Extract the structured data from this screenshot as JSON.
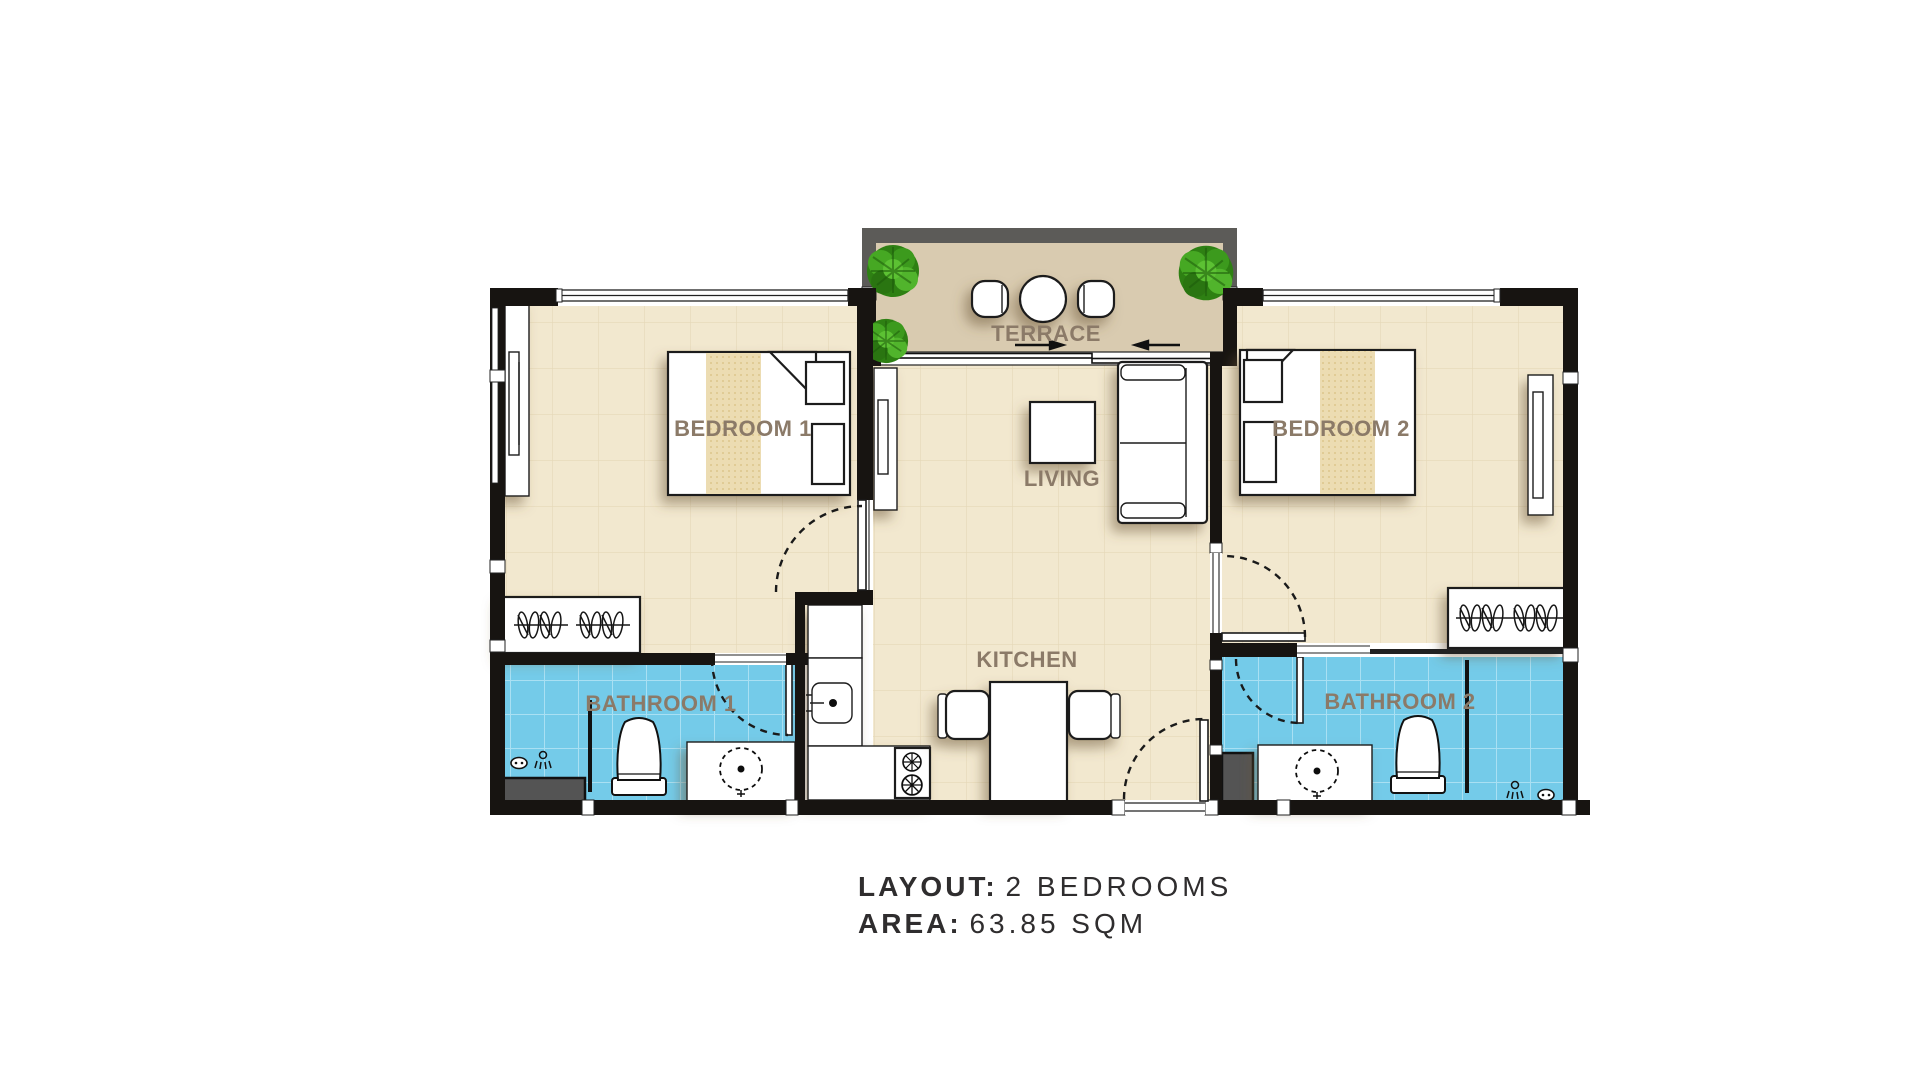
{
  "caption": {
    "line1": {
      "label": "LAYOUT:",
      "value": "2 BEDROOMS"
    },
    "line2": {
      "label": "AREA:",
      "value": "63.85 SQM"
    }
  },
  "plan": {
    "rooms": {
      "terrace": {
        "label": "TERRACE"
      },
      "bedroom1": {
        "label": "BEDROOM 1"
      },
      "bedroom2": {
        "label": "BEDROOM 2"
      },
      "living": {
        "label": "LIVING"
      },
      "kitchen": {
        "label": "KITCHEN"
      },
      "bathroom1": {
        "label": "BATHROOM 1"
      },
      "bathroom2": {
        "label": "BATHROOM 2"
      }
    }
  },
  "colors": {
    "floor": "#f2e8cf",
    "floor-grid": "#e2d4b1",
    "bath": "#74cbe9",
    "bath-grid": "#a9e0f3",
    "terrace-floor": "#d9cbb0",
    "terrace-wall": "#5c5b58",
    "wall": "#171411",
    "label": "#8b7a68",
    "caption": "#2f2d2e",
    "runner": "#ecdcb2",
    "shadow": "#6b5434",
    "shaft": "#545454",
    "plant": "#3e9b22"
  }
}
